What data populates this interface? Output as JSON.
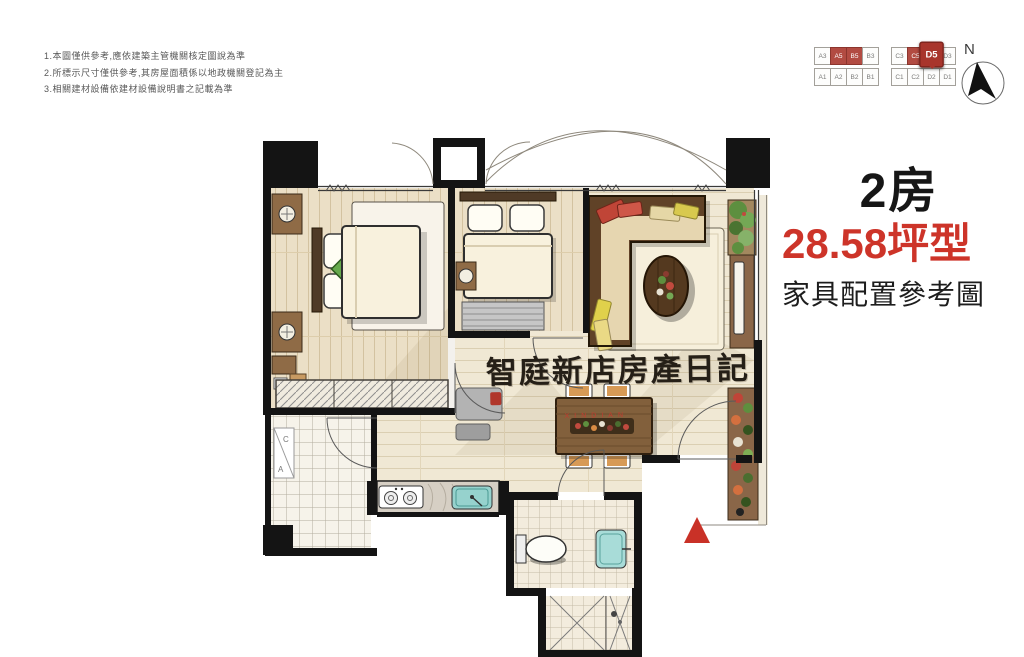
{
  "disclaimer": {
    "lines": [
      "1.本圖僅供參考,應依建築主管機關核定圖說為準",
      "2.所標示尺寸僅供參考,其房屋面積係以地政機關登記為主",
      "3.相關建材設備依建材設備說明書之記載為準"
    ]
  },
  "key_plan": {
    "left_block": {
      "top": [
        {
          "label": "A3",
          "highlight": false,
          "marker": false
        },
        {
          "label": "A5",
          "highlight": true,
          "marker": false
        },
        {
          "label": "B5",
          "highlight": true,
          "marker": false
        },
        {
          "label": "B3",
          "highlight": false,
          "marker": false
        }
      ],
      "bottom": [
        {
          "label": "A1",
          "highlight": false,
          "marker": false
        },
        {
          "label": "A2",
          "highlight": false,
          "marker": false
        },
        {
          "label": "B2",
          "highlight": false,
          "marker": false
        },
        {
          "label": "B1",
          "highlight": false,
          "marker": false
        }
      ]
    },
    "right_block": {
      "top": [
        {
          "label": "C3",
          "highlight": false,
          "marker": false
        },
        {
          "label": "C5",
          "highlight": true,
          "marker": false
        },
        {
          "label": "D5",
          "highlight": true,
          "marker": true
        },
        {
          "label": "D3",
          "highlight": false,
          "marker": false
        }
      ],
      "bottom": [
        {
          "label": "C1",
          "highlight": false,
          "marker": false
        },
        {
          "label": "C2",
          "highlight": false,
          "marker": false
        },
        {
          "label": "D2",
          "highlight": false,
          "marker": false
        },
        {
          "label": "D1",
          "highlight": false,
          "marker": false
        }
      ]
    },
    "marker_unit": "D5"
  },
  "compass": {
    "label": "N"
  },
  "title": {
    "rooms": "2房",
    "size": "28.58坪型",
    "subtitle": "家具配置參考圖",
    "accent_color": "#cd3429"
  },
  "watermark": {
    "text": "智庭新店房產日記",
    "subtext": "XINDIAN"
  },
  "plan": {
    "ac_label_top": "C",
    "ac_label_bottom": "A"
  },
  "colors": {
    "wall": "#141414",
    "accent_red": "#cd3429",
    "keyplan_red": "#b24b42",
    "entrance_marker_red": "#c93127",
    "wood_floor": "#ebdfc6",
    "living_floor": "#f0e8d4",
    "sofa_brown": "#604227",
    "sink_teal": "#96d2cd"
  }
}
